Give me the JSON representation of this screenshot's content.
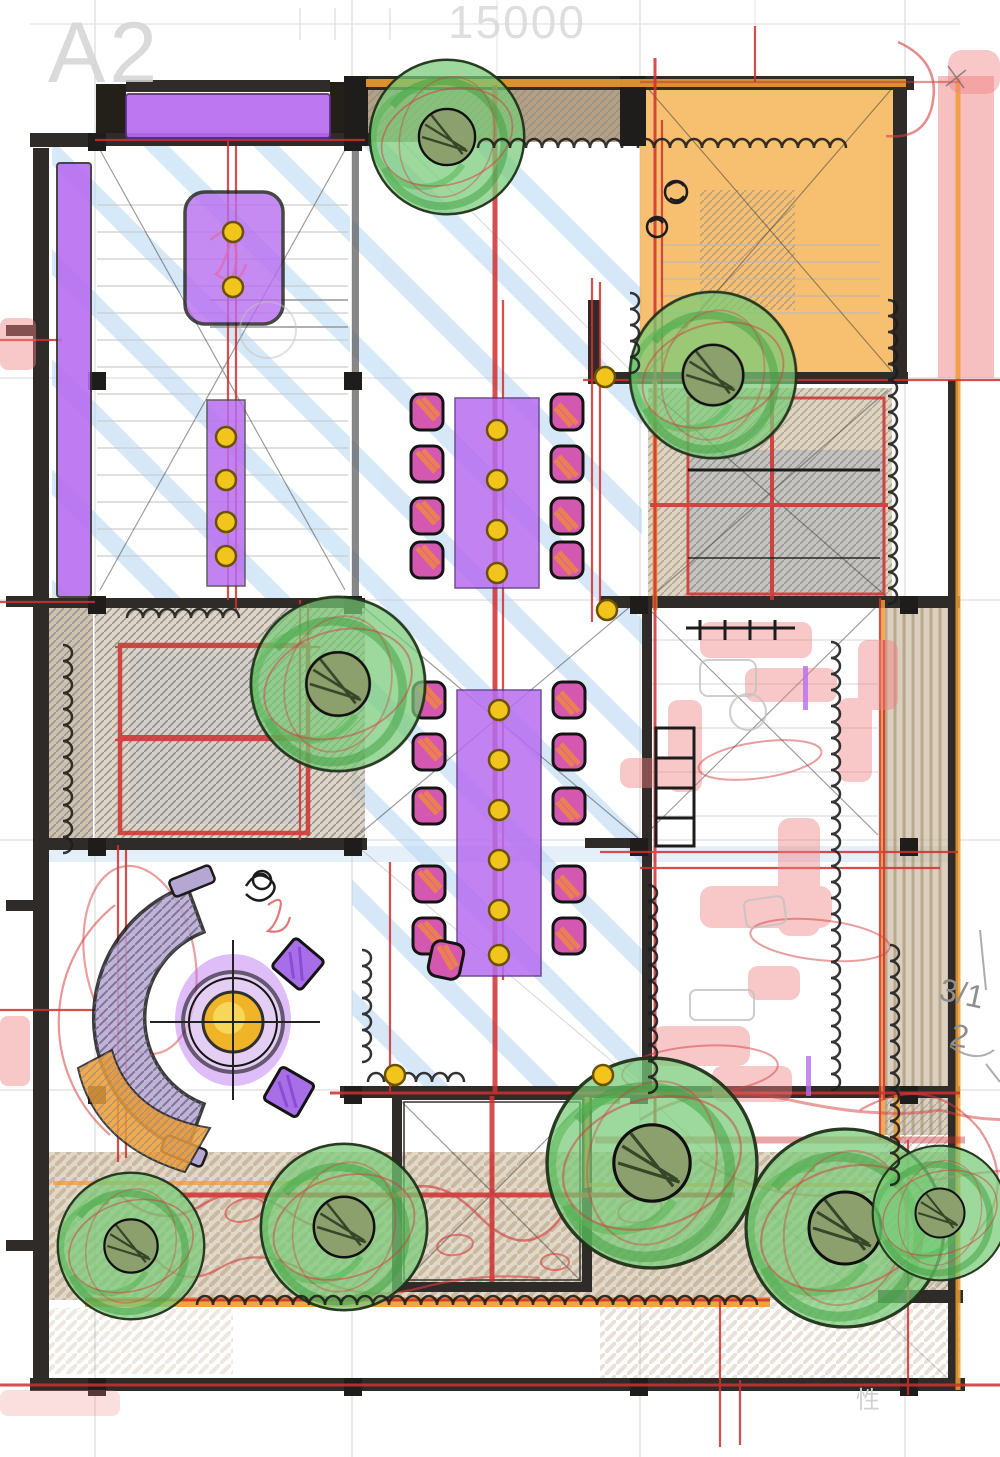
{
  "sheet": {
    "size_label": "A2",
    "top_dimension": "15000"
  },
  "annotations": {
    "margin_note_line1": "3/1",
    "margin_note_line2": "2",
    "stamp_character": "性"
  },
  "palette": {
    "purple": "#b86df0",
    "magenta_chair": "#d457b0",
    "orange_room": "#f5b04c",
    "orange_accent": "#f09c30",
    "green_tree": "#77ca77",
    "red_pen": "#cf3030",
    "red_marker": "#ef8282",
    "blue_stripe": "#aed3f2",
    "tan_ground": "#c3b194",
    "yellow_dot": "#f2c51d",
    "wall_dark": "#2e2b28",
    "sofa_purple": "#b6a6d2"
  }
}
